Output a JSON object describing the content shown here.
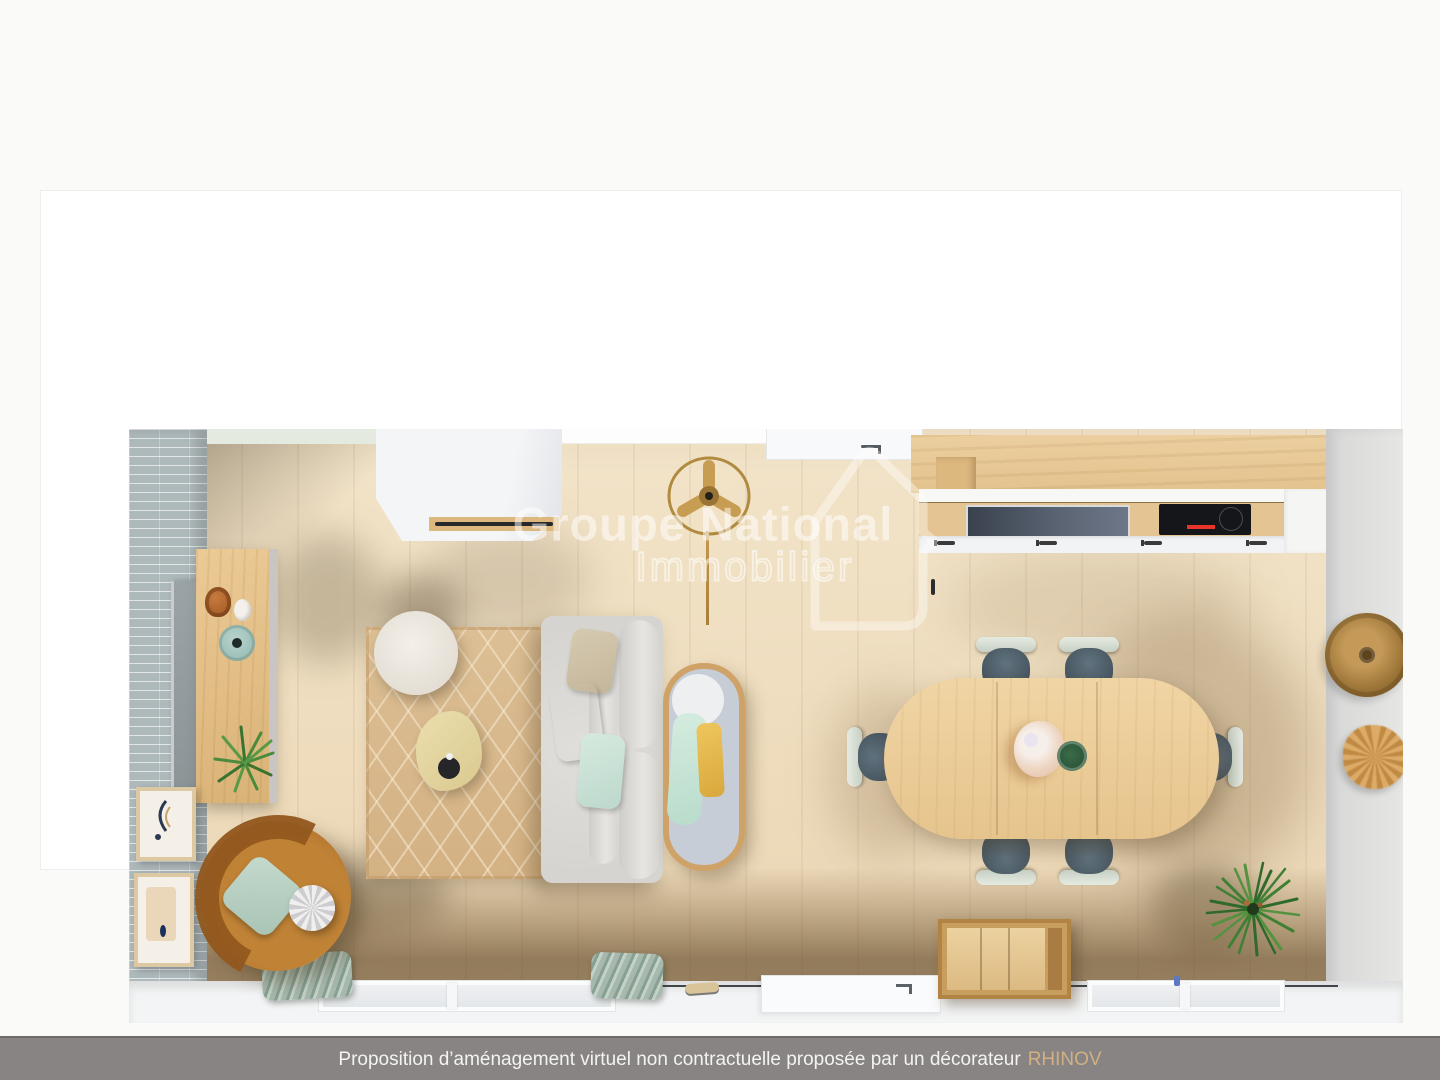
{
  "watermark": {
    "line1": "Groupe National",
    "line2": "Immobilier",
    "logo": "house-outline-icon",
    "color": "#ffffff"
  },
  "caption": {
    "text": "Proposition d’aménagement virtuel non contractuelle proposée par un décorateur",
    "brand": "RHINOV",
    "bar_color": "#878483",
    "text_color": "#f4f3f1",
    "brand_color": "#d2b083"
  },
  "scene": {
    "description": "Vue de dessus 3D d’un séjour ouvert : salon, salle à manger et cuisine linéaire",
    "palette": {
      "floor_wood": "#eedcbd",
      "wall_tiles": "#aeb9bc",
      "wall_green": "#e4eae0",
      "wall_white": "#ffffff",
      "kitchen_wood": "#e5c493",
      "table_wood": "#eccf9c",
      "sofa_gray": "#dcdad6",
      "armchair_camel": "#b4762f",
      "chair_seat_blue": "#56676f",
      "chair_back_sage": "#d6dcd3",
      "rug_jute": "#d9bc92",
      "curtain_sage": "#9cb0a4",
      "pillow_peach": "#eeb98c",
      "pillow_mint": "#cfe5da",
      "pillow_yellow": "#e5bc4e",
      "plant_green": "#3f7d35"
    },
    "items": [
      {
        "id": "tiled-wall",
        "label": "Mur carrelé gris-bleu"
      },
      {
        "id": "wardrobe",
        "label": "Armoire blanche"
      },
      {
        "id": "entry-door",
        "label": "Porte d’entrée"
      },
      {
        "id": "kitchen-run",
        "label": "Cuisine linéaire bois"
      },
      {
        "id": "cooktop",
        "label": "Plaque de cuisson noire"
      },
      {
        "id": "kitchen-sink",
        "label": "Évier vitré"
      },
      {
        "id": "ceiling-fan",
        "label": "Ventilateur de plafond doré"
      },
      {
        "id": "storage-column",
        "label": "Colonne de rangement en bois"
      },
      {
        "id": "leaning-mirror",
        "label": "Miroir posé contre le mur"
      },
      {
        "id": "jute-rug",
        "label": "Tapis en jute à losanges"
      },
      {
        "id": "pouf",
        "label": "Pouf blanc"
      },
      {
        "id": "side-table",
        "label": "Table d’appoint organique"
      },
      {
        "id": "sofa",
        "label": "Canapé gris clair avec coussins"
      },
      {
        "id": "day-bed",
        "label": "Transat ovale liseré bois"
      },
      {
        "id": "armchair",
        "label": "Fauteuil rond camel"
      },
      {
        "id": "dining-table",
        "label": "Table à manger en bois clair"
      },
      {
        "id": "dining-chair",
        "label": "Chaise bleu-gris"
      },
      {
        "id": "centerpiece",
        "label": "Bouquet et mug"
      },
      {
        "id": "wooden-chest",
        "label": "Coffre en bois"
      },
      {
        "id": "green-plant",
        "label": "Plante verte"
      },
      {
        "id": "wall-frames",
        "label": "Cadres décoratifs"
      },
      {
        "id": "wall-decor",
        "label": "Déco murale bois et rotin"
      },
      {
        "id": "window",
        "label": "Fenêtres"
      },
      {
        "id": "curtains",
        "label": "Rideaux sauge"
      }
    ]
  }
}
